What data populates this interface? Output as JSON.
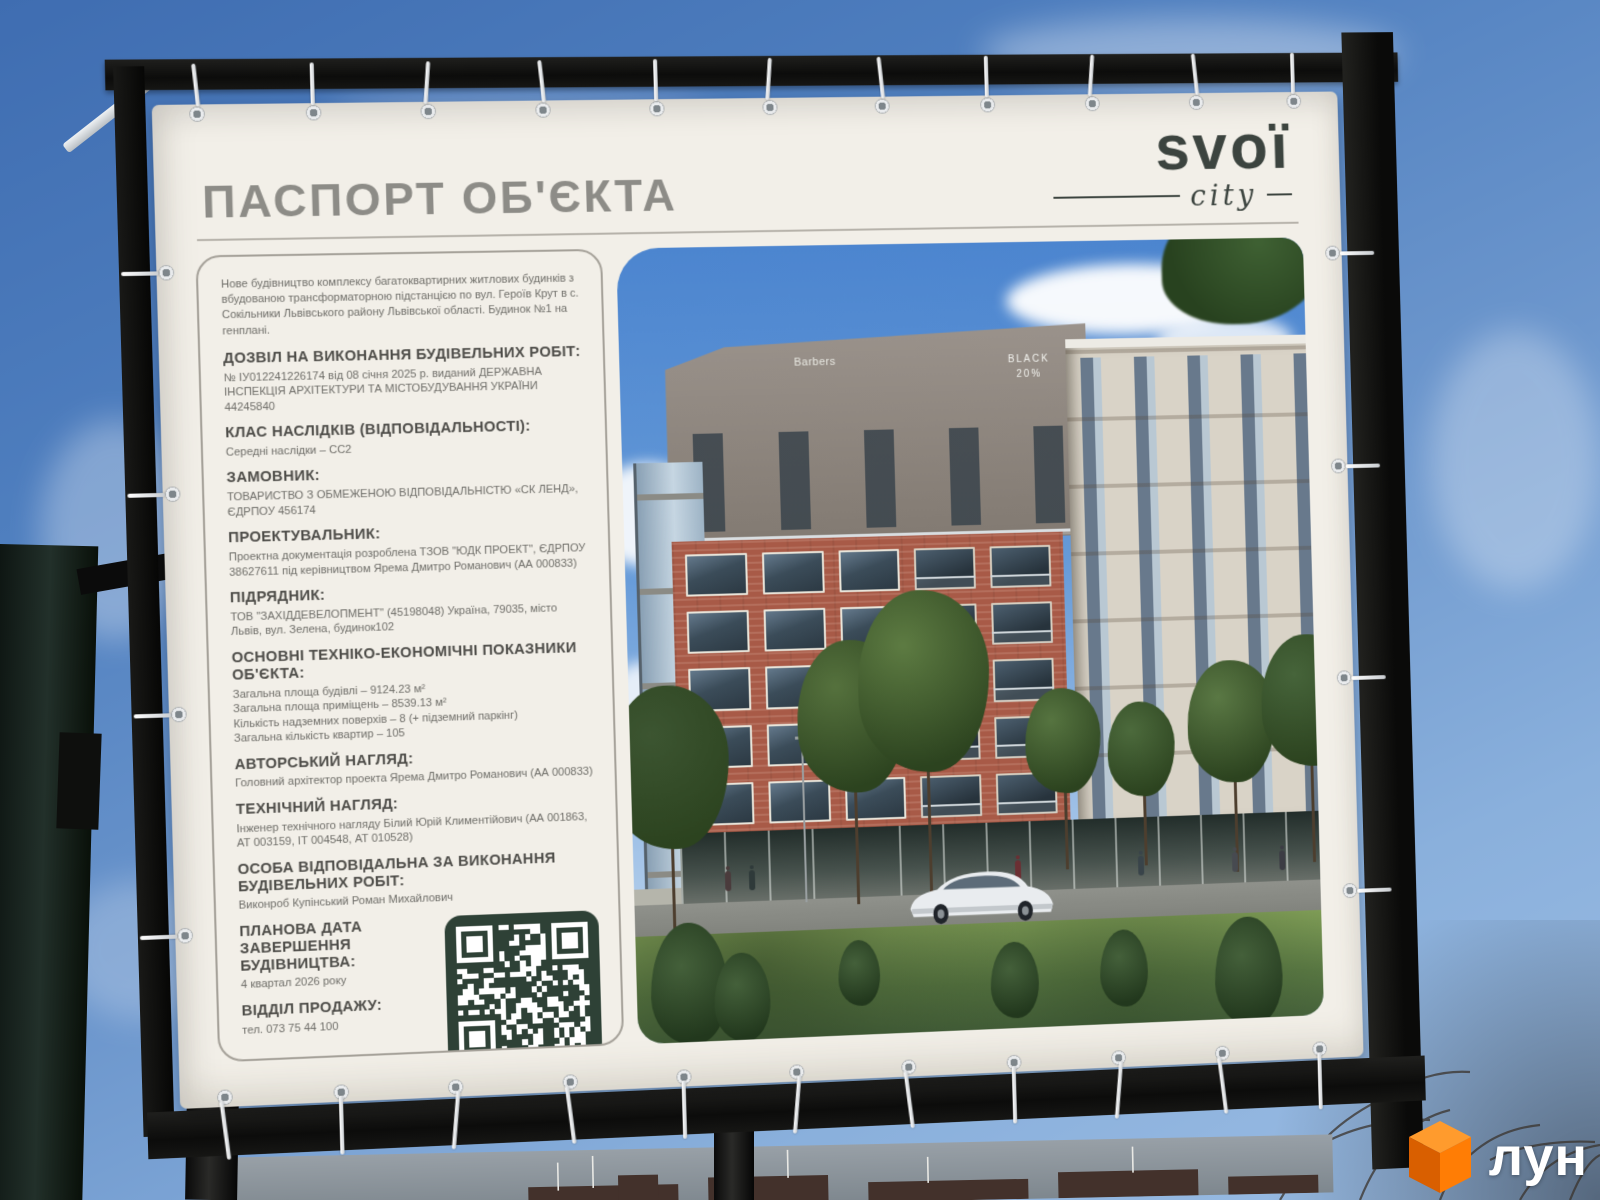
{
  "photo": {
    "billboard": {
      "title": "ПАСПОРТ ОБ'ЄКТА",
      "brand": {
        "name": "svoї",
        "tagline": "city"
      }
    },
    "passport": {
      "intro": "Нове будівництво комплексу багатоквартирних житлових будинків з вбудованою трансформаторною підстанцією по вул. Героїв Крут в с. Сокільники Львівського району Львівської області. Будинок №1 на генплані.",
      "sections": [
        {
          "heading": "ДОЗВІЛ НА ВИКОНАННЯ БУДІВЕЛЬНИХ РОБІТ:",
          "lines": [
            "№ ІУ012241226174 від 08 січня 2025 р. виданий ДЕРЖАВНА ІНСПЕКЦІЯ АРХІТЕКТУРИ ТА МІСТОБУДУВАННЯ УКРАЇНИ 44245840"
          ]
        },
        {
          "heading": "КЛАС НАСЛІДКІВ (ВІДПОВІДАЛЬНОСТІ):",
          "lines": [
            "Середні наслідки – СС2"
          ]
        },
        {
          "heading": "ЗАМОВНИК:",
          "lines": [
            "ТОВАРИСТВО З ОБМЕЖЕНОЮ ВІДПОВІДАЛЬНІСТЮ «СК ЛЕНД», ЄДРПОУ 456174"
          ]
        },
        {
          "heading": "ПРОЕКТУВАЛЬНИК:",
          "lines": [
            "Проектна документація розроблена ТЗОВ \"ЮДК ПРОЕКТ\", ЄДРПОУ 38627611 під керівництвом Ярема Дмитро Романович (АА 000833)"
          ]
        },
        {
          "heading": "ПІДРЯДНИК:",
          "lines": [
            "ТОВ \"ЗАХІДДЕВЕЛОПМЕНТ\" (45198048) Україна, 79035, місто Львів, вул. Зелена, будинок102"
          ]
        },
        {
          "heading": "ОСНОВНІ ТЕХНІКО-ЕКОНОМІЧНІ ПОКАЗНИКИ ОБ'ЄКТА:",
          "lines": [
            "Загальна площа будівлі – 9124.23 м²",
            "Загальна площа приміщень – 8539.13 м²",
            "Кількість надземних поверхів – 8 (+ підземний паркінг)",
            "Загальна кількість квартир – 105"
          ]
        },
        {
          "heading": "АВТОРСЬКИЙ НАГЛЯД:",
          "lines": [
            "Головний архітектор проекта Ярема Дмитро Романович (АА 000833)"
          ]
        },
        {
          "heading": "ТЕХНІЧНИЙ НАГЛЯД:",
          "lines": [
            "Інженер технічного нагляду Білий Юрій Климентійович (АА 001863, АТ 003159, ІТ 004548, АТ 010528)"
          ]
        },
        {
          "heading": "ОСОБА ВІДПОВІДАЛЬНА ЗА ВИКОНАННЯ БУДІВЕЛЬНИХ РОБІТ:",
          "lines": [
            "Виконроб Купінський Роман Михайлович"
          ]
        },
        {
          "heading": "ПЛАНОВА ДАТА ЗАВЕРШЕННЯ БУДІВНИЦТВА:",
          "lines": [
            "4 квартал 2026 року"
          ]
        },
        {
          "heading": "ВІДДІЛ ПРОДАЖУ:",
          "lines": [
            "тел. 073 75 44 100"
          ]
        }
      ]
    },
    "render_scene": {
      "storefront_sign": "Barbers",
      "sale_sign_line1": "BLACK",
      "sale_sign_line2": "20%"
    },
    "watermark": {
      "text": "лун"
    },
    "colors": {
      "qr_green": "#2e4136",
      "brand_ink": "#3c443f",
      "cube_orange": "#ff7d05"
    }
  }
}
